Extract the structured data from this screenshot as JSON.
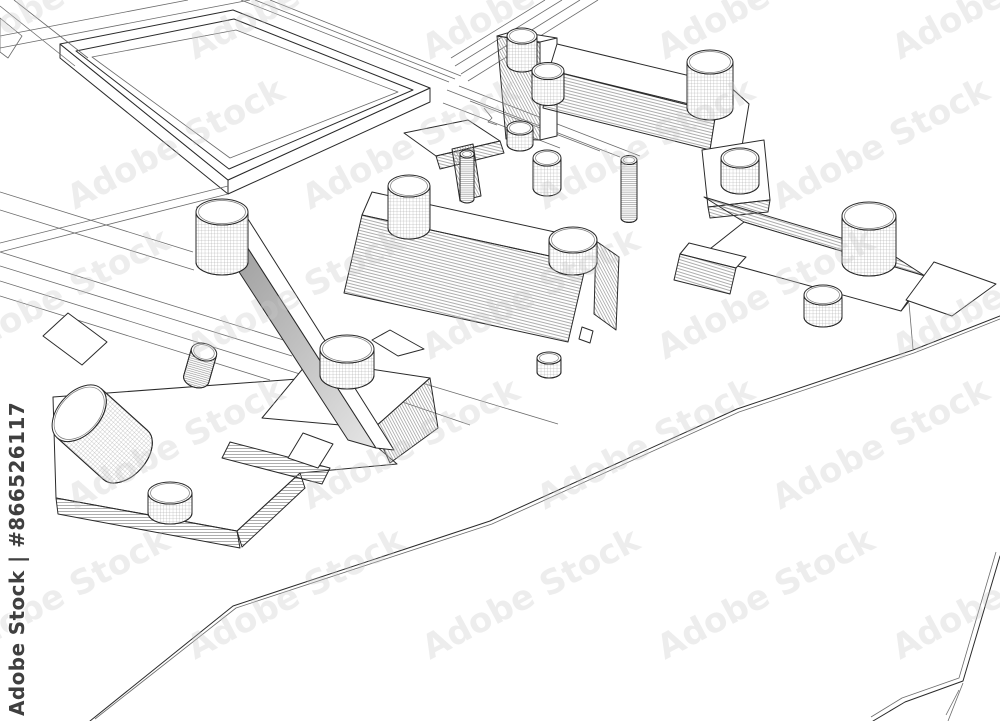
{
  "image": {
    "type_label": "3d-wireframe-architectural-visualization",
    "content_note": "black-and-white wireframe perspective of abstract building blocks with cylindrical bolt-like towers on a site plan with plaza and roads"
  },
  "watermark": {
    "tile_text": "Adobe Stock",
    "id_label": "Adobe Stock | #866526117"
  },
  "colors": {
    "background": "#ffffff",
    "line": "#2a2a2a",
    "hatch": "#8a8a8a",
    "watermark_tile": "#c9c9c9",
    "watermark_id": "#3f3f3f",
    "shade": "#9a9a9a"
  }
}
